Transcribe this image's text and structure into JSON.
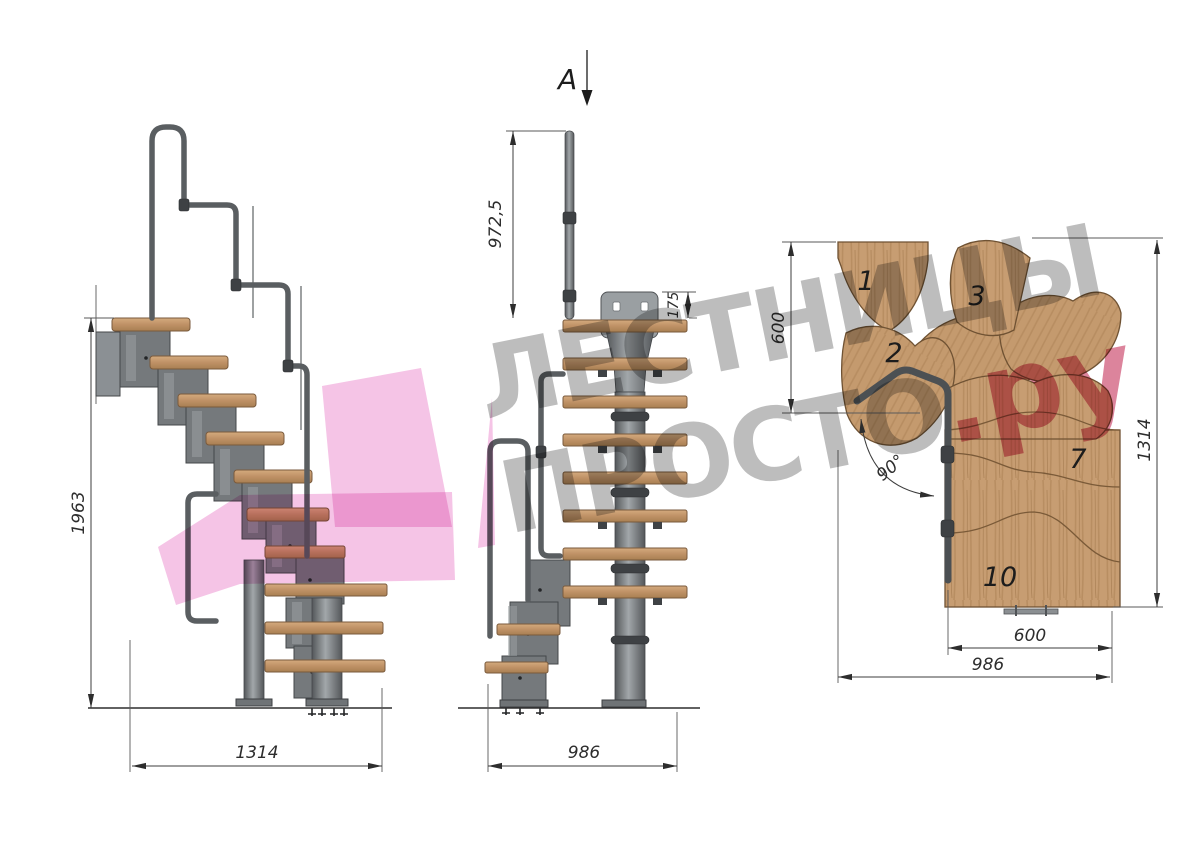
{
  "watermark": {
    "line1": "ЛЕСТНИЦЫ",
    "line2": "ПРОСТО",
    "suffix": ".ру"
  },
  "views": {
    "side": {
      "dims": {
        "height": "1963",
        "width": "1314"
      }
    },
    "front": {
      "section_marker": "A",
      "dims": {
        "rail_height": "972,5",
        "plate_height": "175",
        "width": "986"
      }
    },
    "plan": {
      "dims": {
        "depth": "600",
        "length": "1314",
        "angle": "90°",
        "tread_width": "600",
        "width": "986"
      },
      "tread_numbers": {
        "t1": "1",
        "t2": "2",
        "t3": "3",
        "t7": "7",
        "t10": "10"
      }
    }
  },
  "colors": {
    "wood": "#c79d72",
    "metal": "#75797c",
    "dim_line": "#3c3c3c",
    "watermark_gray": "#787878",
    "watermark_pink": "#c63860",
    "ribbon_pink": "#f2b3df"
  }
}
